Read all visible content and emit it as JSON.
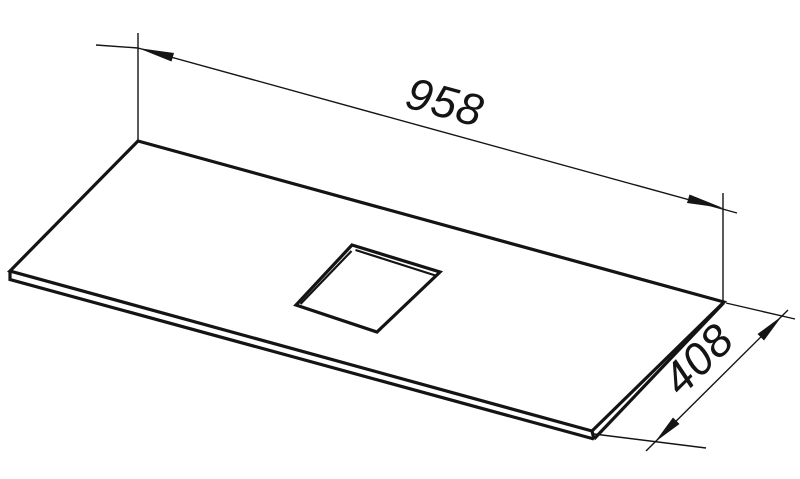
{
  "colors": {
    "line": "#141414",
    "background": "#ffffff"
  },
  "dimensions": {
    "length_label": "958",
    "width_label": "408"
  }
}
